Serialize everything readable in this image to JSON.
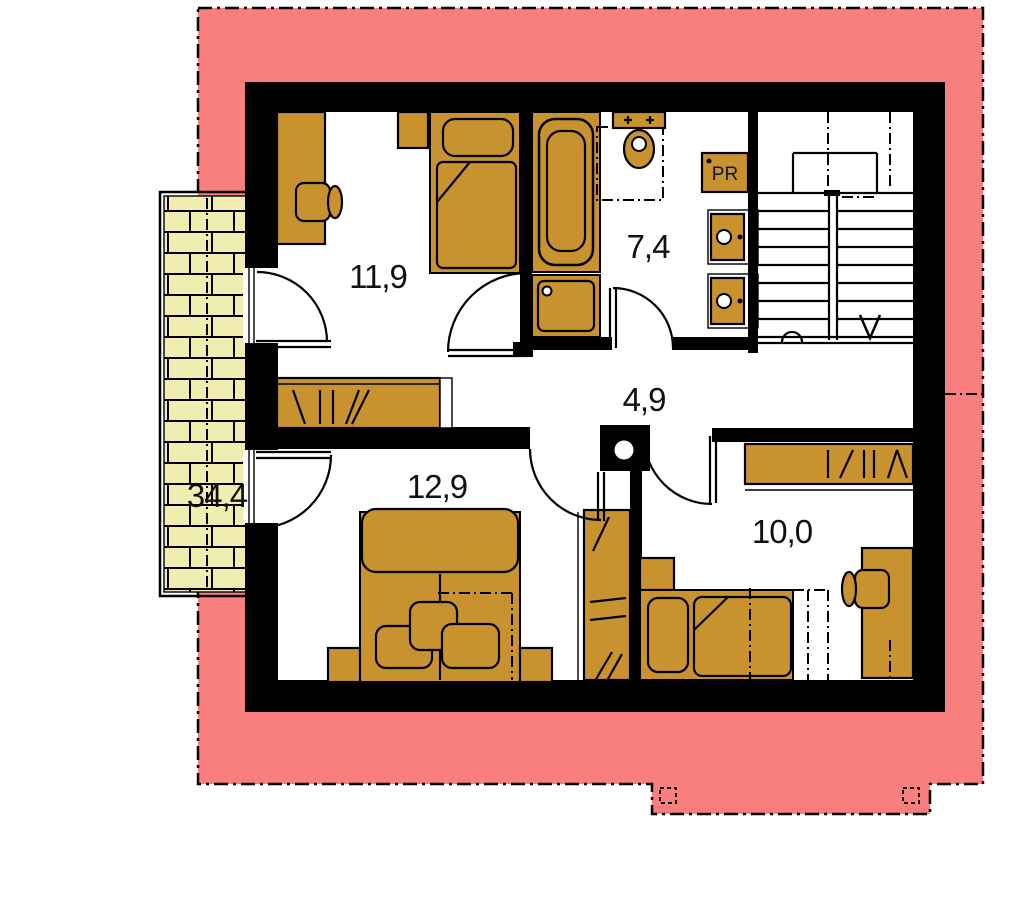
{
  "colors": {
    "roof": "#F97F7F",
    "furniture": "#C8922F",
    "brick": "#F1ECAF",
    "wall": "#000000",
    "paper": "#FFFFFF"
  },
  "plan": {
    "rooms": [
      {
        "name": "bedroom-upper-left",
        "area_label": "11,9"
      },
      {
        "name": "bathroom",
        "area_label": "7,4"
      },
      {
        "name": "hallway",
        "area_label": "4,9"
      },
      {
        "name": "bedroom-lower-left",
        "area_label": "12,9"
      },
      {
        "name": "bedroom-lower-right",
        "area_label": "10,0"
      },
      {
        "name": "balcony",
        "area_label": "34,4"
      }
    ],
    "fixture_labels": {
      "pantry_cabinet": "PR"
    }
  }
}
